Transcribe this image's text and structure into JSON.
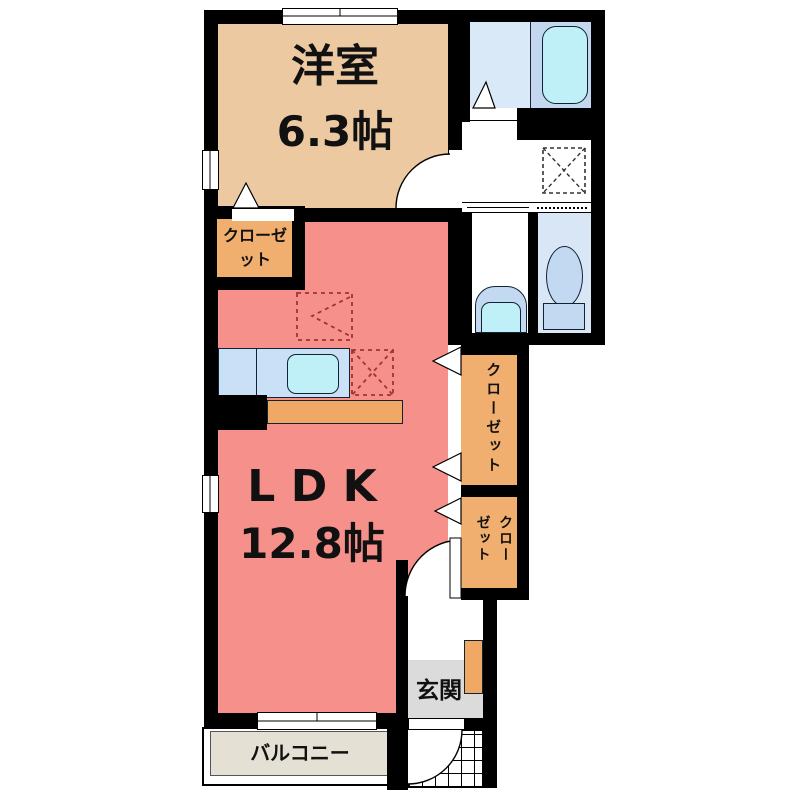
{
  "plan": {
    "rooms": {
      "western_room": {
        "name": "洋室",
        "area": "6.3帖"
      },
      "ldk": {
        "name": "LDK",
        "area": "12.8帖"
      },
      "closet_main": {
        "name": "クローゼット"
      },
      "closet_hall_upper": {
        "name": "クローゼット"
      },
      "closet_hall_lower": {
        "name": "クローゼット"
      },
      "entrance": {
        "name": "玄関"
      },
      "balcony": {
        "name": "バルコニー"
      }
    },
    "fixtures": {
      "bathtub": "bathtub",
      "toilet": "toilet",
      "washbasin": "washbasin",
      "kitchen_sink": "kitchen-sink",
      "refrigerator_space": "refrigerator-space-dashed",
      "dining_space": "dashed-chevron-marker",
      "washer_space": "washing-machine-space-dashed",
      "shoe_cabinet": "shoe-cabinet",
      "entrance_door": "entrance-door-arc"
    },
    "colors": {
      "wall": "#000000",
      "western_room": "#ECC9A1",
      "ldk": "#F6908A",
      "closet": "#F1AF6F",
      "kitchen_counter": "#C9E0F6",
      "counter_front": "#EFA964",
      "bath_floor": "#DAE9F7",
      "bath_tub_area": "#C3D8EF",
      "bathtub": "#C0F0F7",
      "toilet_room": "#D8E6F6",
      "fixture_blue": "#C3D9F1",
      "entrance_floor": "#DBDBDB",
      "balcony_floor": "#E5E0D4",
      "dashed_marker": "#A33333"
    }
  }
}
